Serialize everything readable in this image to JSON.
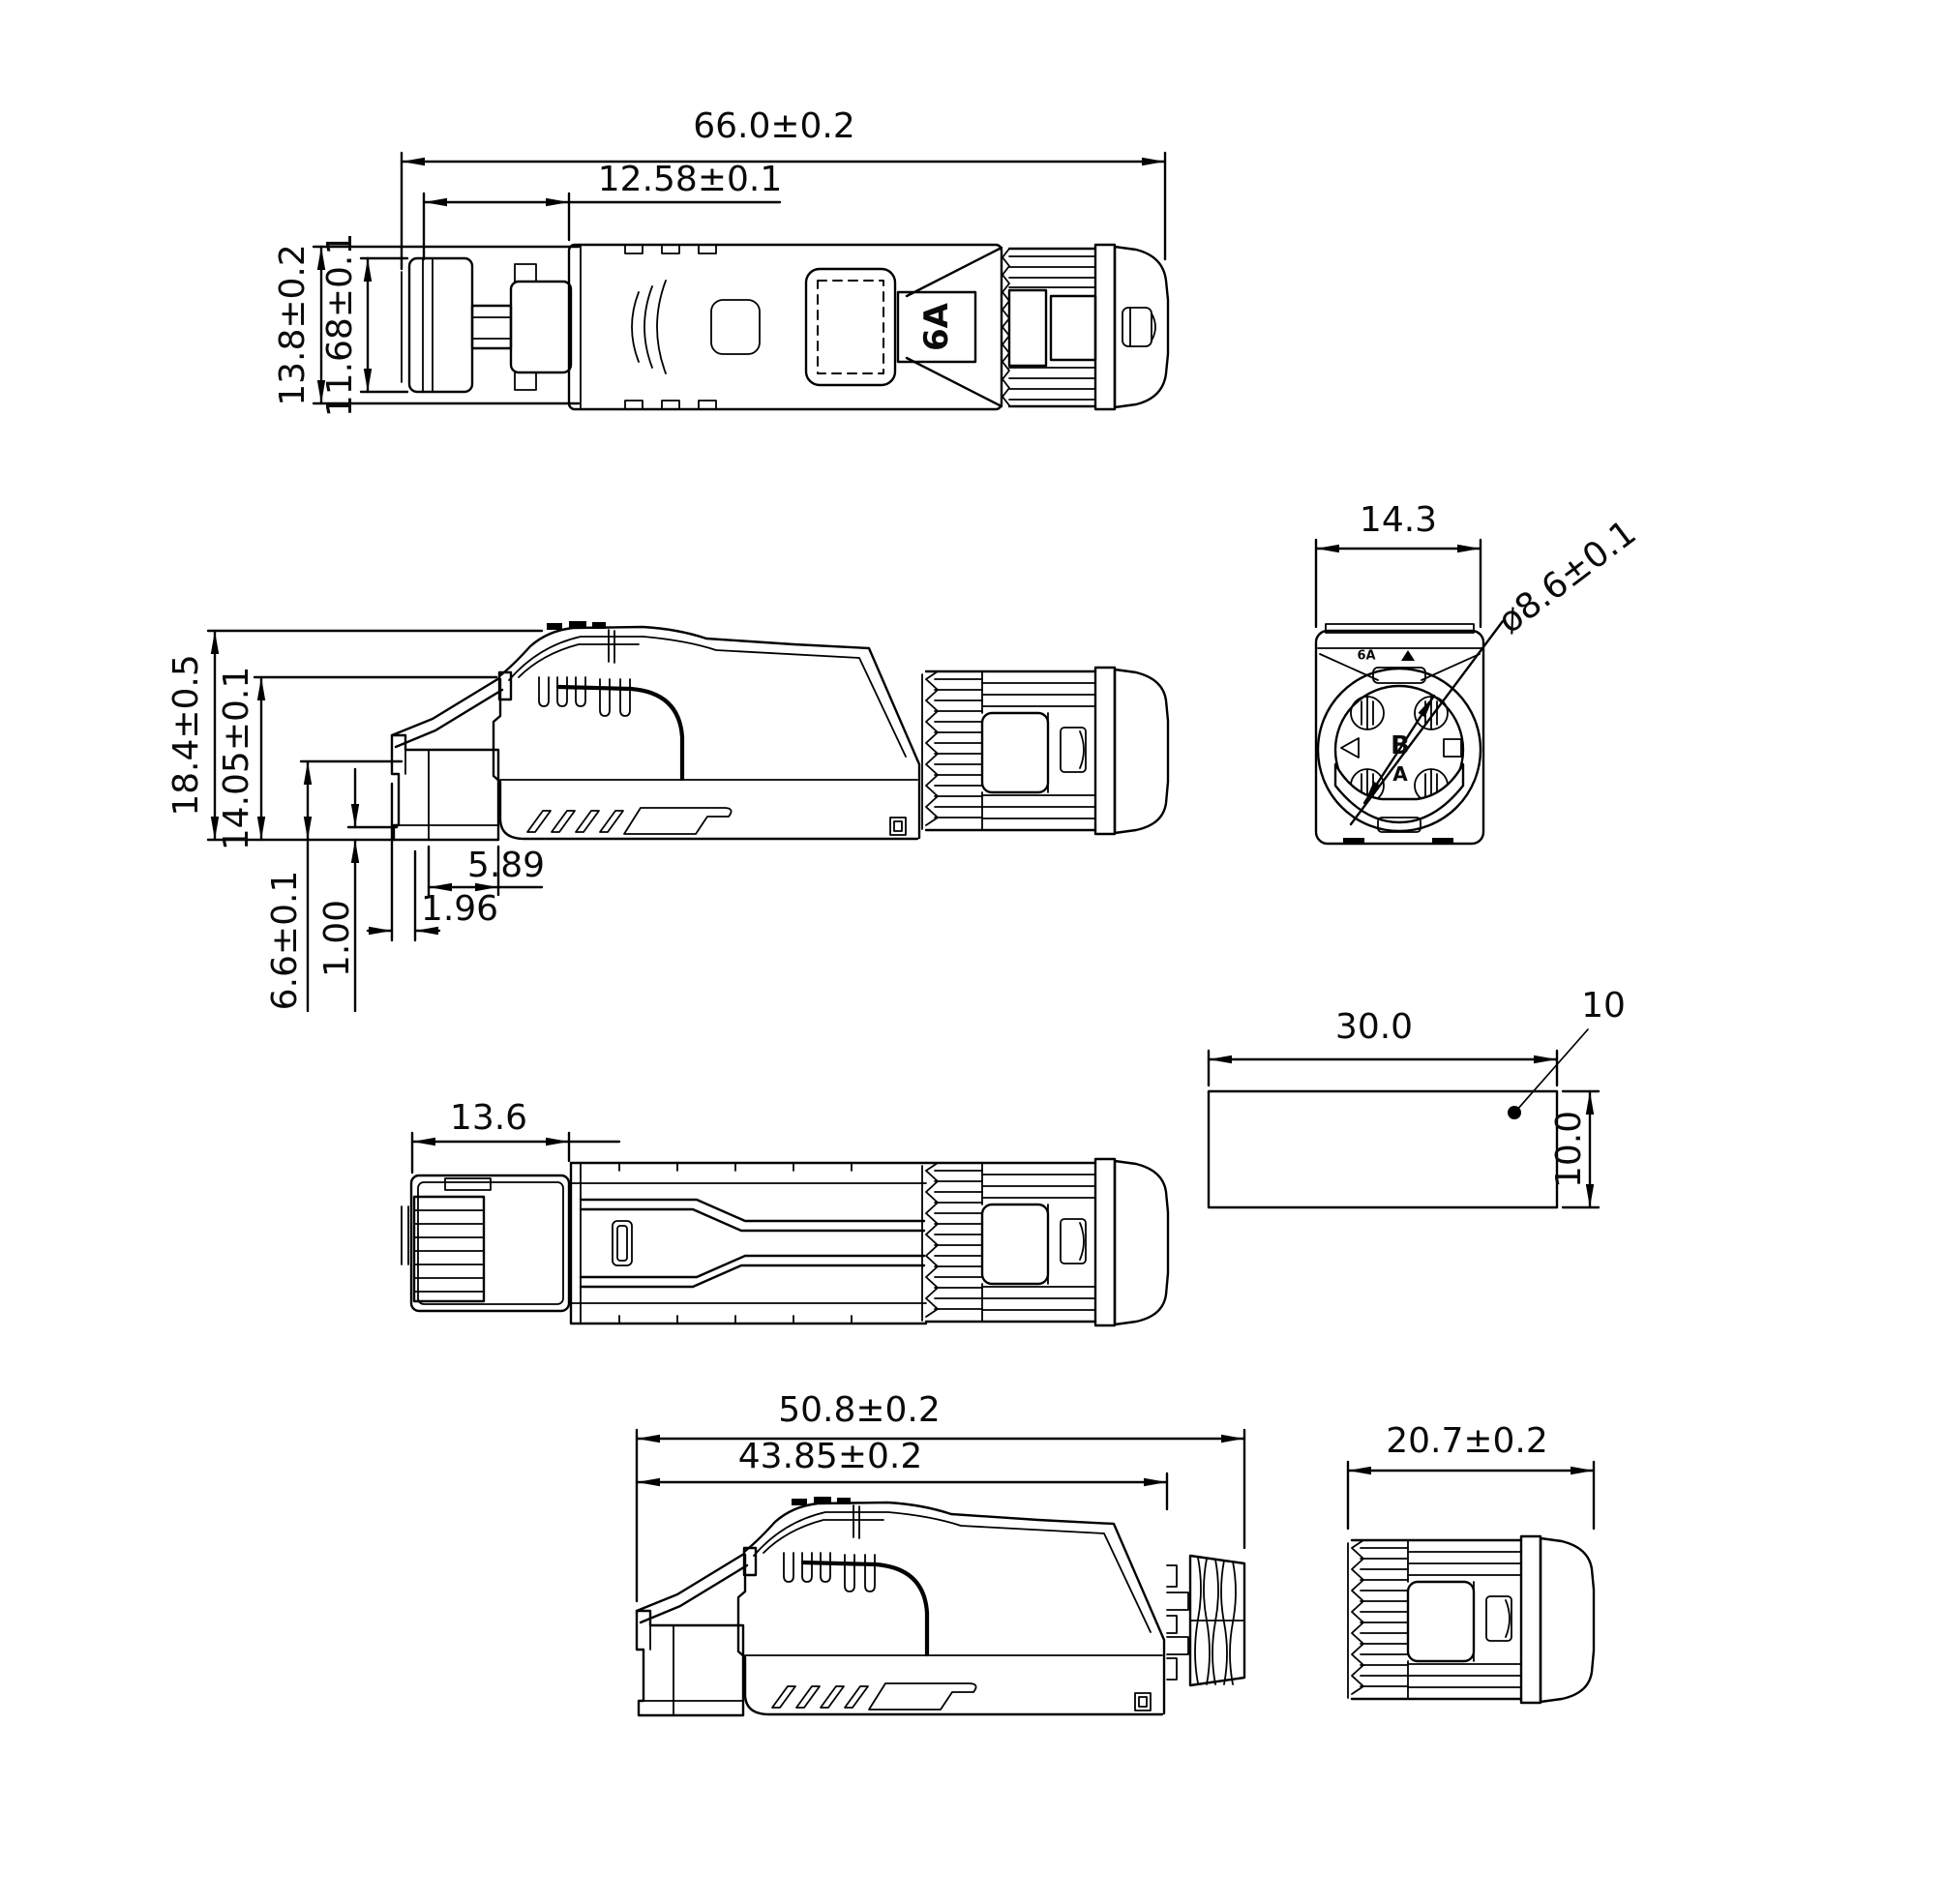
{
  "sheet": {
    "background_color": "#ffffff",
    "line_color": "#000000"
  },
  "dims": {
    "top_overall_length": "66.0±0.2",
    "top_latch_length": "12.58±0.1",
    "top_overall_width": "13.8±0.2",
    "top_plug_width": "11.68±0.1",
    "side_overall_height": "18.4±0.5",
    "side_body_height": "14.05±0.1",
    "side_plug_height": "6.6±0.1",
    "side_lip_height": "1.00",
    "side_step_length": "5.89",
    "side_tip_offset": "1.96",
    "rear_width": "14.3",
    "rear_cable_diameter": "ø8.6±0.1",
    "bottom_plug_length": "13.6",
    "tube_length": "30.0",
    "tube_height": "10.0",
    "tube_callout": "10",
    "noboot_overall_length": "50.8±0.2",
    "noboot_body_length": "43.85±0.2",
    "boot_length": "20.7±0.2"
  },
  "markings": {
    "category_flag": "6A",
    "rear_top": "6A",
    "rear_letter_b": "B",
    "rear_letter_a": "A"
  }
}
